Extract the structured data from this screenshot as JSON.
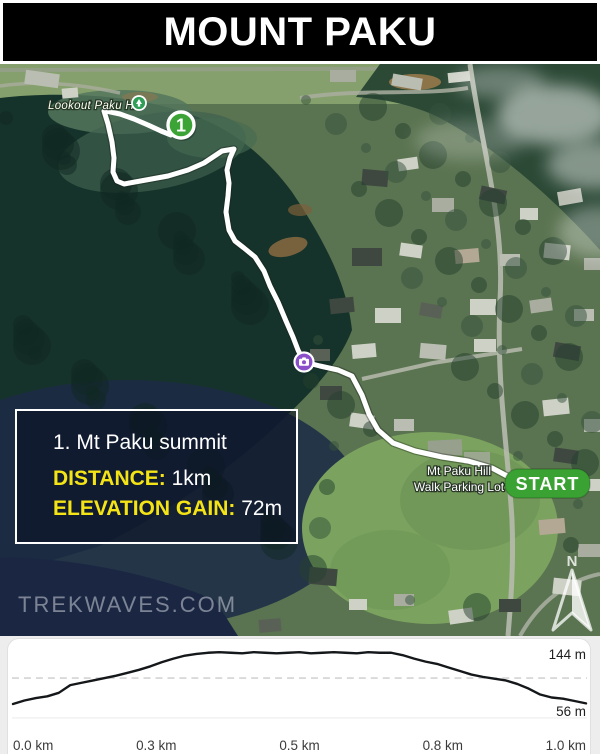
{
  "header": {
    "title": "MOUNT PAKU"
  },
  "map": {
    "labels": {
      "lookout": "Lookout Paku Hill",
      "parking_line1": "Mt Paku Hill",
      "parking_line2": "Walk Parking Lot",
      "watermark": "TREKWAVES.COM",
      "compass_n": "N"
    },
    "markers": {
      "summit": {
        "number": "1",
        "x": 181,
        "y": 125
      },
      "start": {
        "label": "START",
        "x": 505,
        "y": 469,
        "w": 85,
        "h": 29
      },
      "camera": {
        "x": 304,
        "y": 362
      },
      "tree_poi": {
        "x": 139,
        "y": 103
      }
    },
    "trail": {
      "main": [
        [
          509,
          477
        ],
        [
          492,
          468
        ],
        [
          468,
          461
        ],
        [
          442,
          457
        ],
        [
          415,
          451
        ],
        [
          393,
          443
        ],
        [
          378,
          430
        ],
        [
          369,
          414
        ],
        [
          362,
          395
        ],
        [
          352,
          376
        ],
        [
          338,
          370
        ],
        [
          320,
          366
        ],
        [
          304,
          362
        ],
        [
          298,
          350
        ],
        [
          293,
          337
        ],
        [
          286,
          321
        ],
        [
          278,
          302
        ],
        [
          270,
          286
        ],
        [
          264,
          271
        ],
        [
          255,
          257
        ],
        [
          244,
          248
        ],
        [
          235,
          241
        ],
        [
          229,
          230
        ],
        [
          226,
          212
        ],
        [
          228,
          196
        ],
        [
          229,
          183
        ],
        [
          227,
          170
        ],
        [
          230,
          158
        ],
        [
          234,
          149
        ],
        [
          222,
          151
        ],
        [
          204,
          163
        ],
        [
          188,
          170
        ],
        [
          168,
          176
        ],
        [
          146,
          180
        ],
        [
          124,
          184
        ],
        [
          117,
          181
        ],
        [
          113,
          172
        ],
        [
          114,
          158
        ],
        [
          112,
          142
        ],
        [
          108,
          124
        ],
        [
          104,
          111
        ]
      ],
      "summit_spur": [
        [
          106,
          111
        ],
        [
          120,
          114
        ],
        [
          134,
          119
        ],
        [
          148,
          125
        ],
        [
          161,
          131
        ],
        [
          171,
          135
        ]
      ]
    },
    "colors": {
      "trail": "#ffffff",
      "marker_green": "#3ca336",
      "start_green": "#3aa233",
      "camera_purple": "#8a4fc9",
      "poi_green": "#2f9e57",
      "accent_yellow": "#f4e416"
    }
  },
  "info_box": {
    "title": "1. Mt Paku summit",
    "distance_label": "DISTANCE:",
    "distance_value": "1km",
    "elevation_label": "ELEVATION GAIN:",
    "elevation_value": "72m"
  },
  "chart_data": {
    "type": "line",
    "title": "Elevation profile",
    "xlabel": "distance (km)",
    "ylabel": "elevation (m)",
    "xlim": [
      0.0,
      1.0
    ],
    "ylim": [
      56,
      144
    ],
    "grid": "single dashed line at 100 m",
    "legend": "none",
    "ymax_label": "144 m",
    "ymin_label": "56 m",
    "x_tick_labels": [
      "0.0 km",
      "0.3 km",
      "0.5 km",
      "0.8 km",
      "1.0 km"
    ],
    "x": [
      0.0,
      0.02,
      0.04,
      0.06,
      0.08,
      0.1,
      0.12,
      0.14,
      0.16,
      0.18,
      0.2,
      0.22,
      0.24,
      0.26,
      0.28,
      0.3,
      0.32,
      0.34,
      0.36,
      0.38,
      0.4,
      0.42,
      0.44,
      0.46,
      0.48,
      0.5,
      0.52,
      0.54,
      0.56,
      0.58,
      0.6,
      0.62,
      0.64,
      0.66,
      0.68,
      0.7,
      0.72,
      0.74,
      0.76,
      0.78,
      0.8,
      0.82,
      0.84,
      0.86,
      0.88,
      0.9,
      0.92,
      0.94,
      0.96,
      0.98,
      1.0
    ],
    "y": [
      56,
      62,
      66,
      69,
      75,
      88,
      92,
      96,
      100,
      104,
      109,
      114,
      120,
      127,
      133,
      138,
      141,
      143,
      144,
      143,
      142,
      144,
      143,
      142,
      143,
      144,
      142,
      143,
      144,
      143,
      142,
      144,
      143,
      143,
      139,
      133,
      128,
      124,
      118,
      112,
      106,
      102,
      99,
      96,
      90,
      82,
      72,
      67,
      65,
      61,
      57
    ],
    "gridline_m": 100
  }
}
